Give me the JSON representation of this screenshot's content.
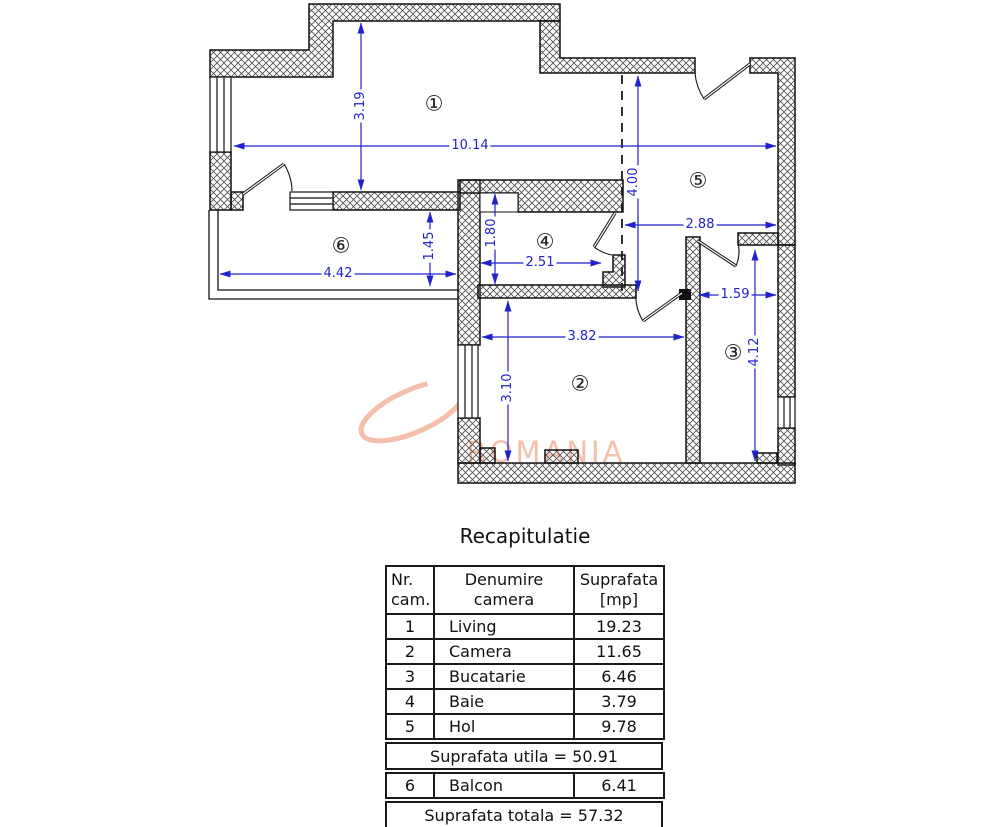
{
  "floorplan": {
    "watermark": "ROMANIA",
    "rooms": [
      {
        "symbol": "①"
      },
      {
        "symbol": "②"
      },
      {
        "symbol": "③"
      },
      {
        "symbol": "④"
      },
      {
        "symbol": "⑤"
      },
      {
        "symbol": "⑥"
      }
    ],
    "dimensions": [
      {
        "text": "3.19"
      },
      {
        "text": "10.14"
      },
      {
        "text": "4.00"
      },
      {
        "text": "2.88"
      },
      {
        "text": "1.80"
      },
      {
        "text": "2.51"
      },
      {
        "text": "1.45"
      },
      {
        "text": "4.42"
      },
      {
        "text": "3.82"
      },
      {
        "text": "3.10"
      },
      {
        "text": "1.59"
      },
      {
        "text": "4.12"
      }
    ],
    "colors": {
      "dimension": "#2222cc",
      "wall_outline": "#111111",
      "watermark": "#f4b49c"
    }
  },
  "recap": {
    "title": "Recapitulatie",
    "table": {
      "headers": [
        "Nr.\ncam.",
        "Denumire\ncamera",
        "Suprafata\n[mp]"
      ],
      "rows": [
        {
          "nr": "1",
          "name": "Living",
          "area": "19.23"
        },
        {
          "nr": "2",
          "name": "Camera",
          "area": "11.65"
        },
        {
          "nr": "3",
          "name": "Bucatarie",
          "area": "6.46"
        },
        {
          "nr": "4",
          "name": "Baie",
          "area": "3.79"
        },
        {
          "nr": "5",
          "name": "Hol",
          "area": "9.78"
        }
      ],
      "utila_text": "Suprafata utila = 50.91",
      "balcon_row": {
        "nr": "6",
        "name": "Balcon",
        "area": "6.41"
      },
      "totala_text": "Suprafata totala = 57.32"
    }
  }
}
